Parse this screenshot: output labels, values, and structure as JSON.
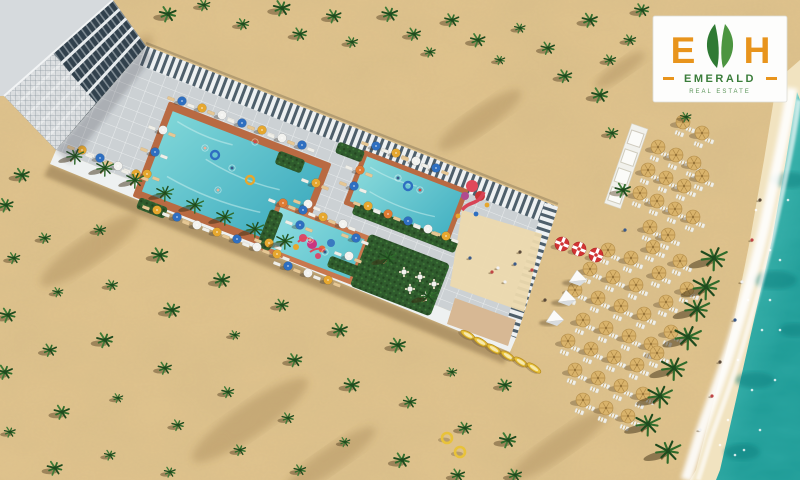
{
  "logo": {
    "letter_e": "E",
    "letter_h": "H",
    "brand": "EMERALD",
    "tagline": "REAL ESTATE",
    "colors": {
      "orange": "#E8941C",
      "green": "#2F7A33",
      "green_light": "#4C9540",
      "text_green": "#3A7D3A",
      "tagline_green": "#5A9459",
      "card": "#FDFDFC"
    }
  },
  "palette": {
    "sand": "#E2C58E",
    "sand_light": "#EFDDB4",
    "sand_wet": "#F1E3C0",
    "dune_shadow": "#8A6B3C",
    "sea_near": "#8FE0D4",
    "sea_deep": "#1F9B96",
    "sea_dark": "#0F7F7E",
    "foam": "#FFFFFF",
    "deck": "#CCD1D4",
    "deck_grout": "#E8EBEC",
    "deck_wall": "#EEF1F1",
    "pergola_light": "#EEF1F2",
    "pergola_dark": "#4E5F6B",
    "pool_border": "#B96A42",
    "pool_light": "#7FD6D8",
    "pool_deep": "#3AA9BD",
    "kids_light": "#8EDCE0",
    "kids_deep": "#5BC2CC",
    "hedge": "#2F5B2D",
    "hedge_dark": "#234520",
    "hedge_light": "#3F7A37",
    "palm": "#2F6B2B",
    "palm_dark": "#1F4A1E",
    "trunk": "#8A6A40",
    "umbrella_colors": [
      "#2E6FC1",
      "#E6A72E",
      "#F2F2EF",
      "#E07B33"
    ],
    "straw": "#D9B36B",
    "straw_rib": "#B08A47",
    "lounger_tan": "#E6C794",
    "lounger_white": "#F0EFE8",
    "lounger_stripe": "#C9A35C",
    "kayak": "#E8C23A",
    "kayak_dark": "#B98D20",
    "kayak_inner": "#F7E9AC",
    "float_red": "#D23333",
    "tent": "#FBFBFA",
    "tent_shade": "#D8DCDF",
    "slide_pink": "#E0485A",
    "slide_red": "#C93636",
    "slide_purple": "#B04A8F",
    "building_roof": "#D6DADD",
    "building_glass": "#31414D",
    "building_slab": "#E8ECEE",
    "path": "#D7B894",
    "sand_deck": "#ECD9AE",
    "person_colors": [
      "#5A4A3A",
      "#C14545",
      "#F0F0F0",
      "#3A5A8A"
    ]
  },
  "scene": {
    "palm_bushes": [
      [
        168,
        14
      ],
      [
        204,
        5
      ],
      [
        243,
        24
      ],
      [
        282,
        8
      ],
      [
        300,
        34
      ],
      [
        334,
        16
      ],
      [
        352,
        42
      ],
      [
        390,
        14
      ],
      [
        414,
        34
      ],
      [
        430,
        52
      ],
      [
        452,
        20
      ],
      [
        478,
        40
      ],
      [
        500,
        60
      ],
      [
        520,
        28
      ],
      [
        548,
        48
      ],
      [
        565,
        76
      ],
      [
        590,
        20
      ],
      [
        610,
        60
      ],
      [
        600,
        95
      ],
      [
        630,
        40
      ],
      [
        642,
        10
      ],
      [
        612,
        133
      ],
      [
        623,
        190
      ],
      [
        686,
        117
      ],
      [
        22,
        175
      ],
      [
        6,
        205
      ],
      [
        14,
        258
      ],
      [
        8,
        315
      ],
      [
        5,
        372
      ],
      [
        10,
        432
      ],
      [
        45,
        238
      ],
      [
        58,
        292
      ],
      [
        50,
        350
      ],
      [
        62,
        412
      ],
      [
        55,
        468
      ],
      [
        100,
        230
      ],
      [
        112,
        285
      ],
      [
        105,
        340
      ],
      [
        118,
        398
      ],
      [
        110,
        455
      ],
      [
        160,
        255
      ],
      [
        172,
        310
      ],
      [
        165,
        368
      ],
      [
        178,
        425
      ],
      [
        170,
        472
      ],
      [
        222,
        280
      ],
      [
        235,
        335
      ],
      [
        228,
        392
      ],
      [
        240,
        450
      ],
      [
        282,
        305
      ],
      [
        295,
        360
      ],
      [
        288,
        418
      ],
      [
        300,
        470
      ],
      [
        340,
        330
      ],
      [
        352,
        385
      ],
      [
        345,
        442
      ],
      [
        398,
        345
      ],
      [
        410,
        402
      ],
      [
        402,
        460
      ],
      [
        452,
        372
      ],
      [
        465,
        428
      ],
      [
        458,
        475
      ],
      [
        505,
        385
      ],
      [
        508,
        440
      ],
      [
        515,
        475
      ]
    ],
    "shore_palms": [
      [
        714,
        258
      ],
      [
        706,
        287
      ],
      [
        697,
        309
      ],
      [
        688,
        337
      ],
      [
        674,
        368
      ],
      [
        660,
        396
      ],
      [
        648,
        424
      ],
      [
        668,
        451
      ]
    ],
    "deck_palms": [
      [
        75,
        156
      ],
      [
        105,
        168
      ],
      [
        135,
        180
      ],
      [
        165,
        193
      ],
      [
        195,
        205
      ],
      [
        225,
        217
      ],
      [
        255,
        229
      ],
      [
        285,
        241
      ],
      [
        428,
        296
      ],
      [
        388,
        258
      ]
    ],
    "beach_umbrellas_upper": [
      [
        683,
        122
      ],
      [
        702,
        133
      ],
      [
        658,
        147
      ],
      [
        676,
        155
      ],
      [
        694,
        163
      ],
      [
        648,
        170
      ],
      [
        666,
        178
      ],
      [
        684,
        186
      ],
      [
        702,
        176
      ],
      [
        640,
        193
      ],
      [
        657,
        201
      ],
      [
        675,
        209
      ],
      [
        693,
        217
      ],
      [
        650,
        227
      ],
      [
        668,
        235
      ]
    ],
    "beach_umbrellas_lower": [
      [
        608,
        250
      ],
      [
        631,
        258
      ],
      [
        653,
        247
      ],
      [
        590,
        269
      ],
      [
        613,
        277
      ],
      [
        636,
        285
      ],
      [
        659,
        273
      ],
      [
        680,
        261
      ],
      [
        575,
        290
      ],
      [
        598,
        298
      ],
      [
        621,
        306
      ],
      [
        644,
        314
      ],
      [
        666,
        302
      ],
      [
        687,
        289
      ],
      [
        583,
        320
      ],
      [
        606,
        328
      ],
      [
        629,
        336
      ],
      [
        651,
        344
      ],
      [
        671,
        332
      ],
      [
        568,
        341
      ],
      [
        591,
        349
      ],
      [
        614,
        357
      ],
      [
        637,
        365
      ],
      [
        657,
        353
      ],
      [
        575,
        370
      ],
      [
        598,
        378
      ],
      [
        621,
        386
      ],
      [
        643,
        394
      ],
      [
        583,
        400
      ],
      [
        606,
        408
      ],
      [
        628,
        416
      ]
    ],
    "pool_umbrellas": [
      [
        182,
        101,
        0
      ],
      [
        202,
        108,
        1
      ],
      [
        222,
        115,
        2
      ],
      [
        242,
        123,
        0
      ],
      [
        262,
        130,
        1
      ],
      [
        282,
        138,
        2
      ],
      [
        302,
        145,
        0
      ],
      [
        316,
        183,
        1
      ],
      [
        308,
        204,
        2
      ],
      [
        300,
        225,
        0
      ],
      [
        157,
        210,
        1
      ],
      [
        177,
        217,
        0
      ],
      [
        197,
        225,
        2
      ],
      [
        217,
        232,
        1
      ],
      [
        237,
        239,
        0
      ],
      [
        257,
        247,
        2
      ],
      [
        277,
        254,
        1
      ],
      [
        163,
        130,
        2
      ],
      [
        155,
        152,
        0
      ],
      [
        147,
        174,
        1
      ],
      [
        82,
        150,
        1
      ],
      [
        100,
        158,
        0
      ],
      [
        118,
        166,
        2
      ],
      [
        136,
        174,
        1
      ],
      [
        376,
        146,
        0
      ],
      [
        396,
        153,
        1
      ],
      [
        416,
        161,
        2
      ],
      [
        436,
        168,
        0
      ],
      [
        368,
        206,
        1
      ],
      [
        388,
        214,
        3
      ],
      [
        408,
        221,
        0
      ],
      [
        428,
        229,
        2
      ],
      [
        446,
        236,
        1
      ],
      [
        360,
        170,
        3
      ],
      [
        354,
        186,
        0
      ],
      [
        283,
        203,
        3
      ],
      [
        303,
        210,
        0
      ],
      [
        323,
        217,
        1
      ],
      [
        343,
        224,
        2
      ],
      [
        288,
        266,
        0
      ],
      [
        308,
        273,
        2
      ],
      [
        328,
        280,
        1
      ],
      [
        356,
        238,
        0
      ],
      [
        349,
        256,
        2
      ],
      [
        269,
        243,
        1
      ]
    ],
    "kayaks": [
      [
        468,
        335,
        30
      ],
      [
        481,
        342,
        31
      ],
      [
        494,
        349,
        32
      ],
      [
        508,
        356,
        33
      ],
      [
        521,
        362,
        34
      ],
      [
        534,
        368,
        35
      ]
    ],
    "rings": [
      [
        447,
        438
      ],
      [
        460,
        452
      ]
    ],
    "floats": [
      [
        562,
        244
      ],
      [
        579,
        249
      ],
      [
        596,
        255
      ]
    ],
    "tents": [
      [
        578,
        277
      ],
      [
        567,
        297
      ],
      [
        555,
        317
      ]
    ],
    "tables": [
      [
        404,
        272
      ],
      [
        420,
        277
      ],
      [
        434,
        284
      ],
      [
        410,
        289
      ],
      [
        426,
        296
      ]
    ],
    "people": [
      [
        520,
        252
      ],
      [
        532,
        270
      ],
      [
        498,
        268
      ],
      [
        470,
        258
      ],
      [
        545,
        300
      ],
      [
        492,
        272
      ],
      [
        505,
        282
      ],
      [
        515,
        264
      ],
      [
        760,
        200
      ],
      [
        752,
        240
      ],
      [
        742,
        282
      ],
      [
        735,
        320
      ],
      [
        720,
        362
      ],
      [
        712,
        396
      ],
      [
        700,
        430
      ],
      [
        625,
        230
      ]
    ],
    "swimmers": [
      [
        205,
        148
      ],
      [
        232,
        168
      ],
      [
        255,
        142
      ],
      [
        218,
        190
      ],
      [
        398,
        178
      ],
      [
        420,
        190
      ],
      [
        310,
        240
      ],
      [
        325,
        252
      ]
    ],
    "pool_rings": [
      [
        215,
        155,
        0
      ],
      [
        250,
        180,
        1
      ],
      [
        408,
        186,
        0
      ]
    ],
    "sea_flecks": [
      [
        756,
        210
      ],
      [
        770,
        250
      ],
      [
        748,
        300
      ],
      [
        762,
        330
      ],
      [
        738,
        360
      ],
      [
        752,
        390
      ],
      [
        728,
        420
      ],
      [
        744,
        450
      ],
      [
        770,
        300
      ],
      [
        780,
        260
      ],
      [
        760,
        430
      ],
      [
        775,
        380
      ],
      [
        788,
        200
      ],
      [
        735,
        455
      ],
      [
        720,
        445
      ],
      [
        780,
        330
      ]
    ],
    "sea_patches": [
      [
        790,
        180,
        18,
        8
      ],
      [
        775,
        280,
        22,
        9
      ],
      [
        755,
        380,
        20,
        8
      ],
      [
        742,
        452,
        18,
        8
      ],
      [
        795,
        330,
        16,
        7
      ]
    ],
    "dune_streaks": [
      [
        90,
        250,
        60,
        14
      ],
      [
        250,
        420,
        70,
        16
      ],
      [
        480,
        120,
        50,
        12
      ],
      [
        560,
        445,
        60,
        12
      ],
      [
        120,
        60,
        40,
        10
      ],
      [
        620,
        70,
        30,
        8
      ],
      [
        330,
        460,
        55,
        12
      ]
    ]
  }
}
